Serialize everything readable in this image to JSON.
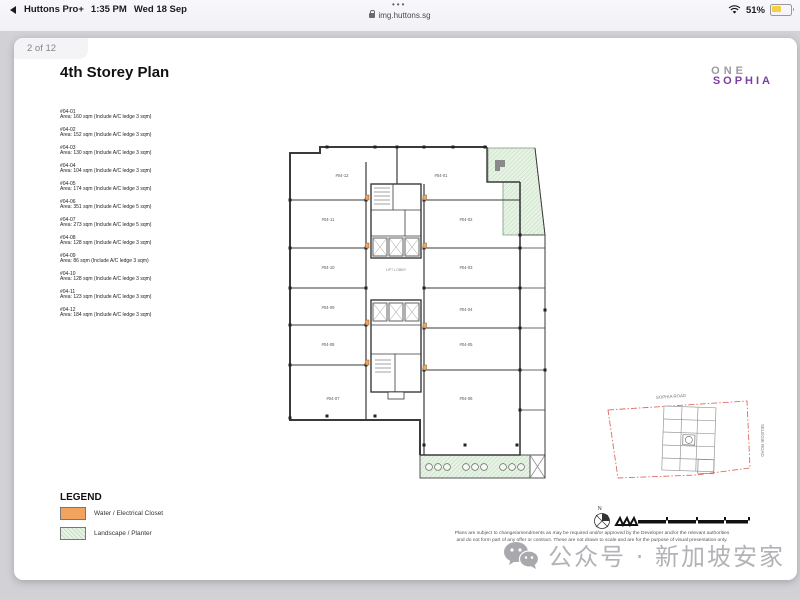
{
  "status_bar": {
    "back_app": "Huttons Pro+",
    "time": "1:35 PM",
    "date": "Wed 18 Sep",
    "tab_dots": "•••",
    "url": "img.huttons.sg",
    "battery_percent": "51%",
    "battery_color": "#f6d040"
  },
  "viewer": {
    "page_indicator": "2 of 12"
  },
  "document": {
    "title": "4th Storey Plan",
    "logo": {
      "line1": "ONE",
      "line2": "SOPHIA",
      "accent_color": "#7b3fa0"
    },
    "units": [
      {
        "no": "#04-01",
        "area": "Area: 160 sqm (Include A/C ledge 3 sqm)"
      },
      {
        "no": "#04-02",
        "area": "Area: 152 sqm (Include A/C ledge 3 sqm)"
      },
      {
        "no": "#04-03",
        "area": "Area: 130 sqm (Include A/C ledge 3 sqm)"
      },
      {
        "no": "#04-04",
        "area": "Area: 104 sqm (Include A/C ledge 3 sqm)"
      },
      {
        "no": "#04-05",
        "area": "Area: 174 sqm (Include A/C ledge 3 sqm)"
      },
      {
        "no": "#04-06",
        "area": "Area: 351 sqm (Include A/C ledge 5 sqm)"
      },
      {
        "no": "#04-07",
        "area": "Area: 273 sqm (Include A/C ledge 5 sqm)"
      },
      {
        "no": "#04-08",
        "area": "Area: 128 sqm (Include A/C ledge 3 sqm)"
      },
      {
        "no": "#04-09",
        "area": "Area: 86 sqm (Include A/C ledge 3 sqm)"
      },
      {
        "no": "#04-10",
        "area": "Area: 128 sqm (Include A/C ledge 3 sqm)"
      },
      {
        "no": "#04-11",
        "area": "Area: 123 sqm (Include A/C ledge 3 sqm)"
      },
      {
        "no": "#04-12",
        "area": "Area: 184 sqm (Include A/C ledge 3 sqm)"
      }
    ],
    "plan": {
      "unit_labels": [
        "#04-12",
        "#04-01",
        "#04-11",
        "#04-02",
        "#04-10",
        "#04-03",
        "#04-09",
        "#04-04",
        "#04-08",
        "#04-05",
        "#04-07",
        "#04-06"
      ],
      "core_label": "LIFT LOBBY",
      "colors": {
        "closet": "#F2A35E",
        "planter": "#E7F3E4",
        "wall": "#3a3a3a"
      }
    },
    "legend": {
      "title": "LEGEND",
      "items": [
        {
          "label": "Water / Electrical Closet",
          "color": "#F2A35E"
        },
        {
          "label": "Landscape / Planter",
          "color": "#E7F3E4"
        }
      ]
    },
    "site_map": {
      "road_top": "SOPHIA ROAD",
      "road_right": "SELEGIE ROAD",
      "north_label": "N"
    },
    "disclaimer_line1": "Plans are subject to change/amendments as may be required and/or approved by the Developer and/or the relevant authorities",
    "disclaimer_line2": "and do not form part of any offer or contract. These are not drawn to scale and are for the purpose of visual presentation only."
  },
  "watermark": {
    "text": "公众号 · 新加坡安家"
  }
}
